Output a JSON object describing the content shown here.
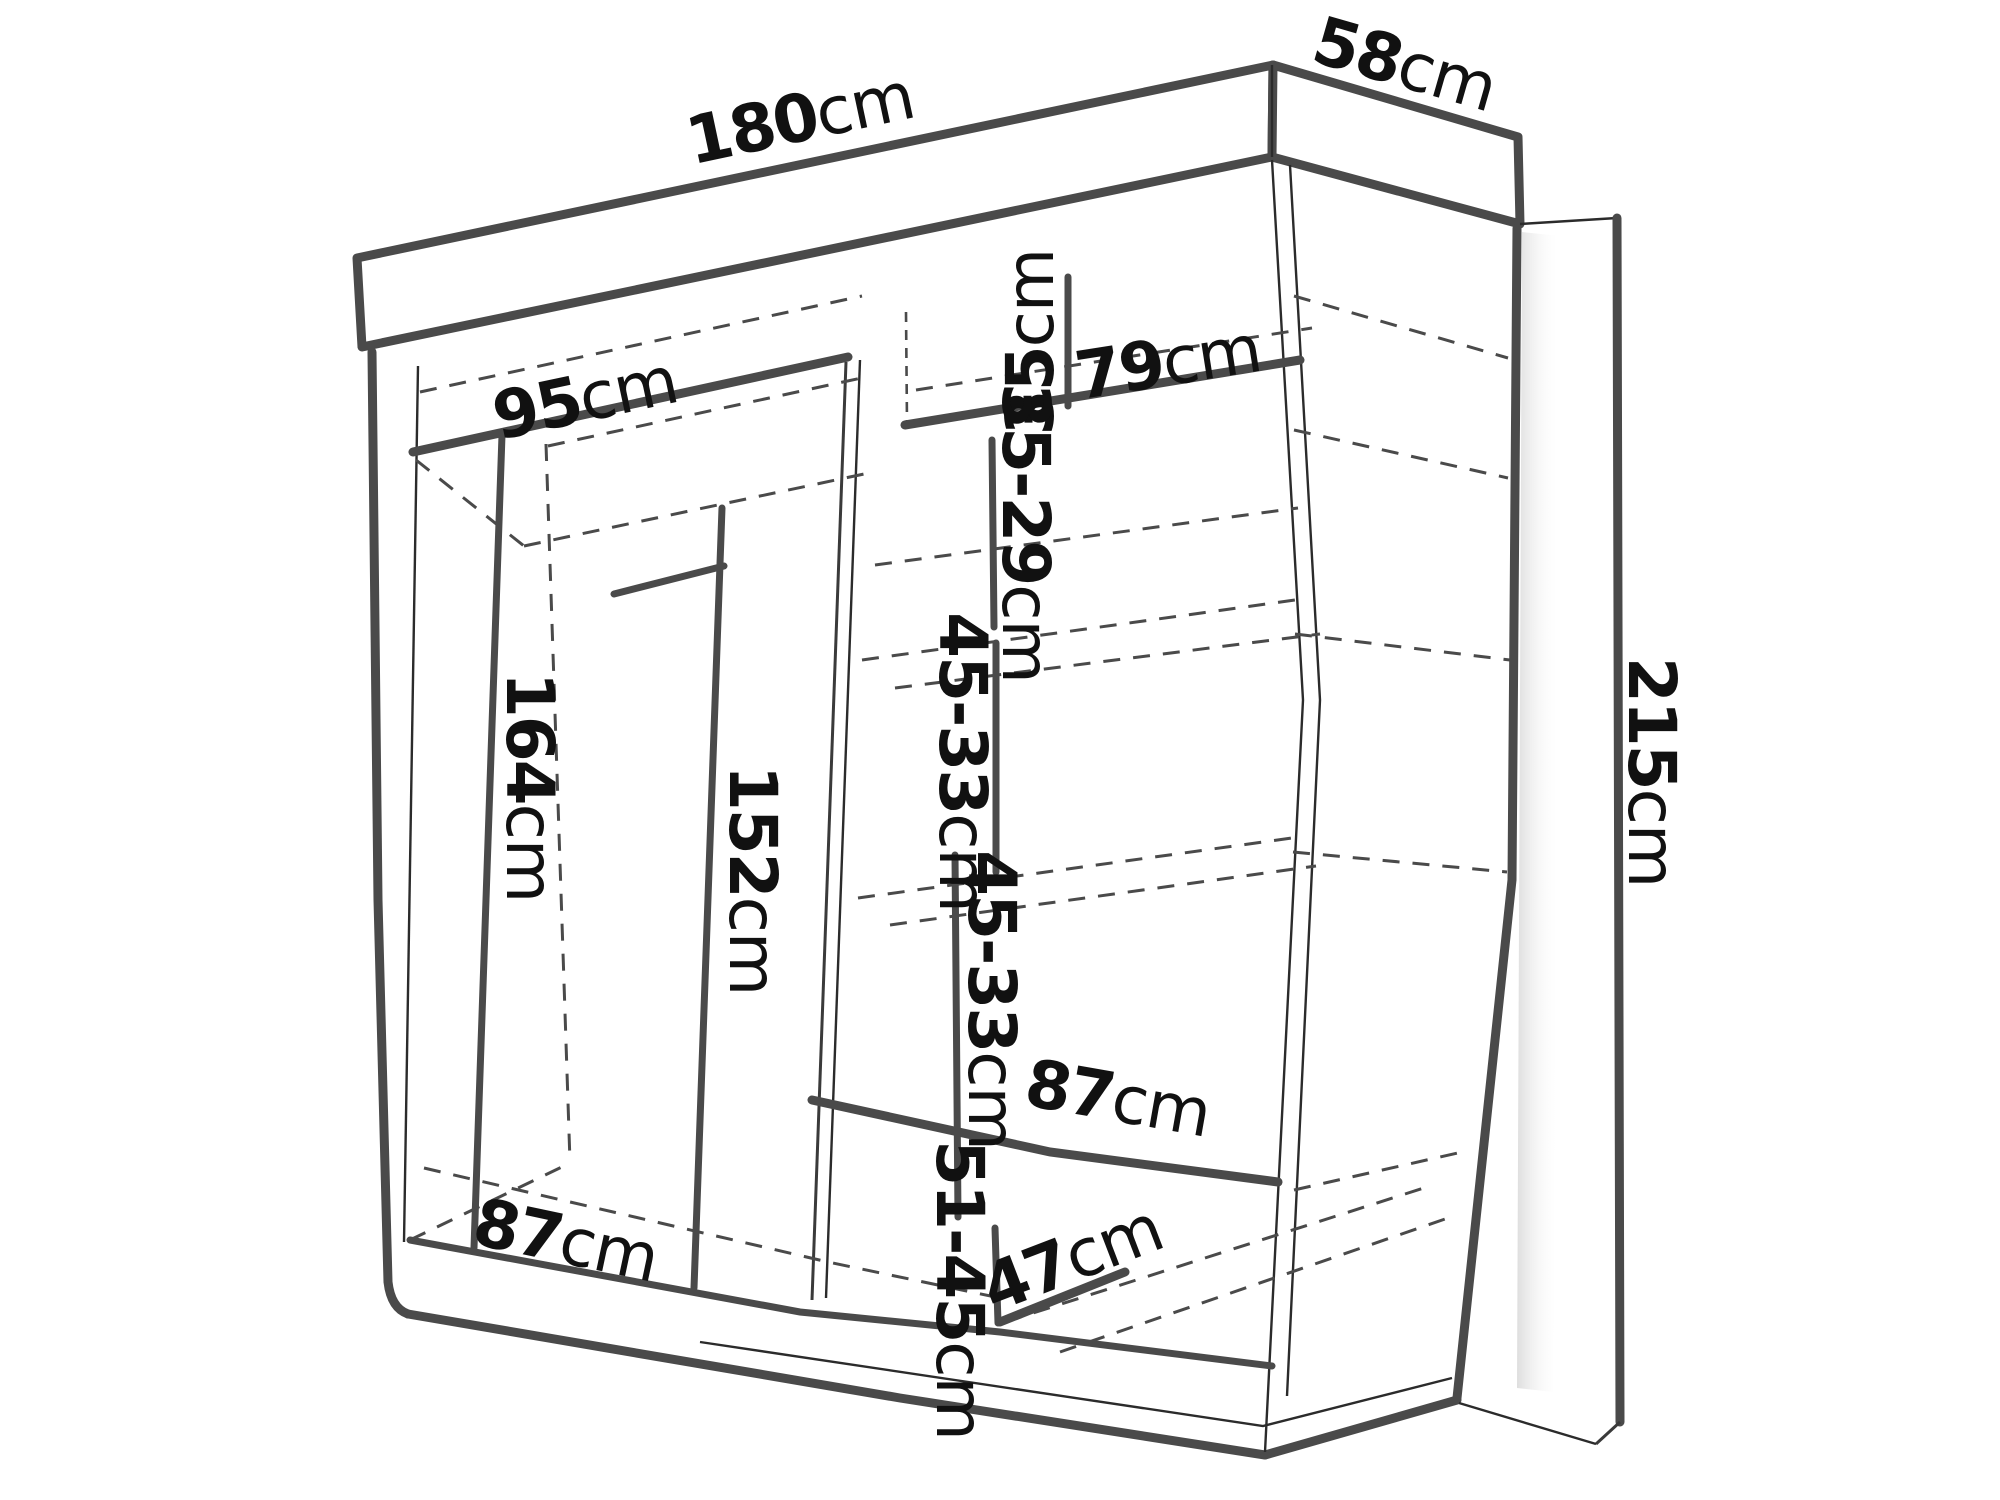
{
  "diagram": {
    "type": "furniture-dimension-diagram",
    "subject": "Sliding-door wardrobe technical line drawing with interior shelf and rail measurements",
    "unit": "cm",
    "overall_dimensions": {
      "width_cm": 180,
      "depth_cm": 58,
      "height_cm": 215
    },
    "dimensions": {
      "width_top": {
        "value": "180",
        "unit": "cm"
      },
      "depth_top": {
        "value": "58",
        "unit": "cm"
      },
      "height_side": {
        "value": "215",
        "unit": "cm"
      },
      "rod_width": {
        "value": "95",
        "unit": "cm"
      },
      "top_shelf_width": {
        "value": "79",
        "unit": "cm"
      },
      "top_shelf_drop": {
        "value": "35",
        "unit": "cm"
      },
      "upper_shelf_gap": {
        "value": "35-29",
        "unit": "cm"
      },
      "mid_shelf_gap_1": {
        "value": "45-33",
        "unit": "cm"
      },
      "mid_shelf_gap_2": {
        "value": "45-33",
        "unit": "cm"
      },
      "rod_height": {
        "value": "164",
        "unit": "cm"
      },
      "inner_height": {
        "value": "152",
        "unit": "cm"
      },
      "left_bay_width": {
        "value": "87",
        "unit": "cm"
      },
      "right_shelf_width": {
        "value": "87",
        "unit": "cm"
      },
      "bottom_gap": {
        "value": "51-45",
        "unit": "cm"
      },
      "bottom_depth": {
        "value": "47",
        "unit": "cm"
      }
    },
    "colors": {
      "line": "#4a4a4a",
      "thin_line": "#2b2b2b",
      "dashed": "#4a4a4a",
      "text": "#111111",
      "background": "#ffffff"
    }
  }
}
